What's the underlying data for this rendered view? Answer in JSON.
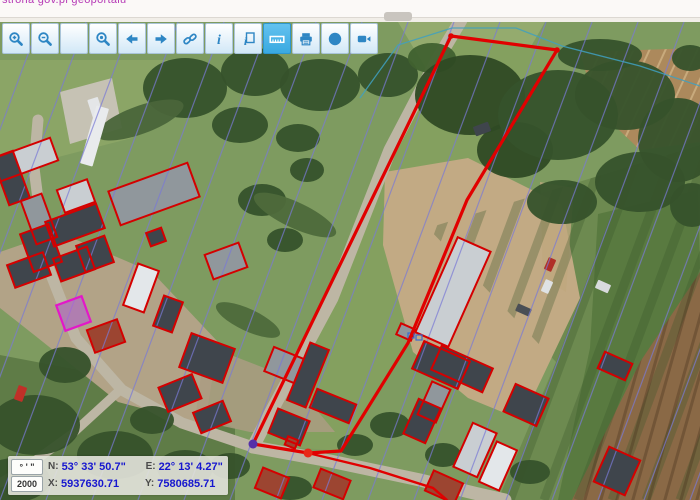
{
  "page": {
    "link_text": "strona gov.pl geoportalu"
  },
  "toolbar": {
    "buttons": [
      {
        "name": "zoom-in",
        "icon": "zoom-in-icon",
        "active": false
      },
      {
        "name": "zoom-out",
        "icon": "zoom-out-icon",
        "active": false
      },
      {
        "name": "pan",
        "icon": "pan-icon",
        "active": false
      },
      {
        "name": "zoom-extent",
        "icon": "zoom-extent-icon",
        "active": false
      },
      {
        "name": "back",
        "icon": "back-arrow-icon",
        "active": false
      },
      {
        "name": "forward",
        "icon": "forward-arrow-icon",
        "active": false
      },
      {
        "name": "link",
        "icon": "link-icon",
        "active": false
      },
      {
        "name": "info",
        "icon": "info-icon",
        "active": false
      },
      {
        "name": "identify",
        "icon": "identify-icon",
        "active": false
      },
      {
        "name": "measure",
        "icon": "measure-icon",
        "active": true
      },
      {
        "name": "print",
        "icon": "print-icon",
        "active": false
      },
      {
        "name": "globe",
        "icon": "globe-icon",
        "active": false
      },
      {
        "name": "camera",
        "icon": "camera-icon",
        "active": false
      }
    ],
    "icon_color": "#2e86c4",
    "active_icon_color": "#ffffff"
  },
  "coords_panel": {
    "dms_button": "° ' \"",
    "scale_value": "2000",
    "n_label": "N:",
    "n_value": "53° 33' 50.7\"",
    "e_label": "E:",
    "e_value": "22° 13' 4.27\"",
    "x_label": "X:",
    "x_value": "5937630.71",
    "y_label": "Y:",
    "y_value": "7580685.71"
  },
  "map": {
    "base_color": "#7e9b60",
    "roof_colors": {
      "dark": "#3f454c",
      "gray": "#90979c",
      "light": "#c9ced2",
      "white": "#e3e7ea",
      "red": "#9c4531",
      "tan": "#b9a98e"
    },
    "parcel_color": "#e10000",
    "cadastral_color": "#7a7ad6",
    "cyan_color": "#3fa0c0",
    "magenta_color": "#e318c8",
    "patches": [
      {
        "pts": [
          [
            0,
            60
          ],
          [
            168,
            60
          ],
          [
            132,
            138
          ],
          [
            0,
            172
          ]
        ],
        "fill": "#8ba566"
      },
      {
        "pts": [
          [
            398,
            22
          ],
          [
            545,
            22
          ],
          [
            522,
            62
          ],
          [
            428,
            72
          ]
        ],
        "fill": "#94ab6e"
      },
      {
        "pts": [
          [
            451,
            36
          ],
          [
            557,
            50
          ],
          [
            467,
            200
          ],
          [
            408,
            343
          ],
          [
            341,
            451
          ],
          [
            253,
            444
          ]
        ],
        "fill": "#84a05f"
      },
      {
        "pts": [
          [
            428,
            228
          ],
          [
            700,
            145
          ],
          [
            700,
            500
          ],
          [
            498,
            500
          ],
          [
            556,
            362
          ]
        ],
        "fill": "#6d8a50"
      },
      {
        "pts": [
          [
            598,
            214
          ],
          [
            698,
            190
          ],
          [
            700,
            268
          ],
          [
            622,
            500
          ],
          [
            558,
            500
          ],
          [
            590,
            348
          ]
        ],
        "fill": "#597a40"
      },
      {
        "pts": [
          [
            580,
            52
          ],
          [
            700,
            48
          ],
          [
            700,
            142
          ],
          [
            640,
            150
          ],
          [
            596,
            108
          ]
        ],
        "fill": "#ac895c"
      },
      {
        "pts": [
          [
            700,
            272
          ],
          [
            700,
            500
          ],
          [
            572,
            500
          ],
          [
            640,
            362
          ]
        ],
        "fill": "#8a6946"
      },
      {
        "pts": [
          [
            0,
            355
          ],
          [
            120,
            378
          ],
          [
            235,
            428
          ],
          [
            235,
            500
          ],
          [
            0,
            500
          ]
        ],
        "fill": "#5f7c47"
      },
      {
        "pts": [
          [
            0,
            252
          ],
          [
            58,
            232
          ],
          [
            152,
            272
          ],
          [
            218,
            342
          ],
          [
            205,
            425
          ],
          [
            118,
            402
          ],
          [
            38,
            338
          ],
          [
            0,
            308
          ]
        ],
        "fill": "#b2a387"
      },
      {
        "pts": [
          [
            205,
            345
          ],
          [
            290,
            378
          ],
          [
            335,
            432
          ],
          [
            250,
            432
          ],
          [
            195,
            420
          ]
        ],
        "fill": "#aa9c82",
        "opacity": 0.85
      },
      {
        "pts": [
          [
            385,
            172
          ],
          [
            468,
            158
          ],
          [
            562,
            205
          ],
          [
            580,
            298
          ],
          [
            522,
            420
          ],
          [
            468,
            398
          ],
          [
            413,
            352
          ],
          [
            383,
            245
          ]
        ],
        "fill": "#c2aa84"
      },
      {
        "pts": [
          [
            540,
            182
          ],
          [
            574,
            188
          ],
          [
            566,
            292
          ],
          [
            543,
            278
          ]
        ],
        "fill": "#bfa77e",
        "opacity": 0.8
      },
      {
        "pts": [
          [
            60,
            92
          ],
          [
            112,
            78
          ],
          [
            122,
            128
          ],
          [
            70,
            144
          ]
        ],
        "fill": "#c6c2b4"
      }
    ],
    "stripe_groups": [
      {
        "clip": [
          [
            428,
            228
          ],
          [
            700,
            145
          ],
          [
            700,
            500
          ],
          [
            498,
            500
          ],
          [
            556,
            362
          ]
        ],
        "x_from": 470,
        "x_to": 870,
        "step": 34,
        "dx": -130,
        "y1": 150,
        "y2": 500,
        "color": "rgba(55,85,42,0.30)",
        "width": 9
      },
      {
        "clip": [
          [
            580,
            52
          ],
          [
            700,
            48
          ],
          [
            700,
            142
          ],
          [
            640,
            150
          ],
          [
            596,
            108
          ]
        ],
        "x_from": 590,
        "x_to": 780,
        "step": 16,
        "dx": -55,
        "y1": 40,
        "y2": 160,
        "color": "rgba(235,210,165,0.45)",
        "width": 2
      },
      {
        "clip": [
          [
            700,
            272
          ],
          [
            700,
            500
          ],
          [
            572,
            500
          ],
          [
            640,
            362
          ]
        ],
        "x_from": 620,
        "x_to": 850,
        "step": 16,
        "dx": -70,
        "y1": 260,
        "y2": 510,
        "color": "rgba(60,40,22,0.30)",
        "width": 3
      }
    ],
    "roads": [
      {
        "pts": [
          [
            461,
            20
          ],
          [
            436,
            62
          ],
          [
            390,
            150
          ],
          [
            332,
            298
          ],
          [
            271,
            412
          ],
          [
            253,
            447
          ]
        ],
        "width": 13
      },
      {
        "pts": [
          [
            253,
            447
          ],
          [
            330,
            461
          ],
          [
            420,
            480
          ],
          [
            478,
            494
          ],
          [
            505,
            500
          ]
        ],
        "width": 13
      },
      {
        "pts": [
          [
            253,
            447
          ],
          [
            182,
            423
          ],
          [
            122,
            390
          ],
          [
            76,
            338
          ],
          [
            46,
            262
          ],
          [
            34,
            168
          ],
          [
            38,
            120
          ]
        ],
        "width": 11
      },
      {
        "pts": [
          [
            120,
            390
          ],
          [
            72,
            434
          ],
          [
            22,
            470
          ],
          [
            0,
            483
          ]
        ],
        "width": 9
      }
    ],
    "road_color": "#bdb6a4",
    "trees": [
      [
        185,
        88,
        42,
        30,
        0
      ],
      [
        255,
        72,
        34,
        24,
        0
      ],
      [
        320,
        85,
        40,
        26,
        0
      ],
      [
        388,
        75,
        30,
        22,
        0
      ],
      [
        432,
        58,
        24,
        15,
        0,
        "#40612f"
      ],
      [
        240,
        125,
        28,
        18,
        0
      ],
      [
        298,
        138,
        22,
        14,
        0
      ],
      [
        262,
        200,
        24,
        16,
        0
      ],
      [
        285,
        240,
        18,
        12,
        0
      ],
      [
        307,
        170,
        17,
        12,
        0
      ],
      [
        470,
        95,
        55,
        40,
        0,
        "#2f4a24"
      ],
      [
        515,
        150,
        38,
        28,
        0,
        "#2f4a24"
      ],
      [
        558,
        115,
        60,
        45,
        0
      ],
      [
        625,
        95,
        50,
        35,
        0
      ],
      [
        678,
        140,
        40,
        42,
        0
      ],
      [
        640,
        182,
        45,
        30,
        0
      ],
      [
        562,
        202,
        35,
        22,
        0
      ],
      [
        600,
        55,
        42,
        16,
        0
      ],
      [
        692,
        205,
        22,
        22,
        0
      ],
      [
        140,
        120,
        46,
        14,
        -20,
        "#4a653a"
      ],
      [
        295,
        215,
        45,
        13,
        25,
        "#4e6a3b"
      ],
      [
        248,
        320,
        35,
        11,
        25,
        "#4e6a3b"
      ],
      [
        35,
        425,
        45,
        30,
        0
      ],
      [
        115,
        455,
        38,
        24,
        0
      ],
      [
        185,
        468,
        28,
        18,
        0
      ],
      [
        65,
        365,
        26,
        18,
        0
      ],
      [
        15,
        480,
        35,
        22,
        0
      ],
      [
        152,
        420,
        22,
        14,
        0
      ],
      [
        230,
        466,
        20,
        13,
        0
      ],
      [
        290,
        488,
        22,
        12,
        0
      ],
      [
        355,
        445,
        18,
        11,
        0
      ],
      [
        390,
        425,
        20,
        13,
        0
      ],
      [
        443,
        455,
        18,
        12,
        0
      ],
      [
        530,
        472,
        20,
        12,
        0
      ],
      [
        690,
        58,
        18,
        13,
        0
      ]
    ],
    "tree_color": "#36522b",
    "vehicles": [
      [
        16,
        386,
        9,
        15,
        20,
        "#c03028"
      ],
      [
        90,
        98,
        11,
        20,
        -18,
        "#e4e6e8"
      ],
      [
        546,
        258,
        8,
        13,
        24,
        "#b03028"
      ],
      [
        543,
        280,
        8,
        13,
        24,
        "#dfe2e4"
      ],
      [
        516,
        306,
        15,
        8,
        24,
        "#4a4f55"
      ],
      [
        474,
        124,
        16,
        10,
        -20,
        "#3f454c"
      ],
      [
        596,
        282,
        14,
        9,
        24,
        "#d8dadd"
      ],
      [
        88,
        106,
        13,
        60,
        16,
        "#e9ebed"
      ]
    ],
    "buildings": [
      [
        -8,
        148,
        64,
        24,
        -20,
        "light",
        "red"
      ],
      [
        112,
        176,
        84,
        36,
        -20,
        "gray",
        "red"
      ],
      [
        0,
        153,
        22,
        50,
        -20,
        "dark",
        "red"
      ],
      [
        28,
        196,
        22,
        46,
        -20,
        "gray",
        "red"
      ],
      [
        48,
        212,
        54,
        26,
        -20,
        "dark",
        "red"
      ],
      [
        60,
        184,
        32,
        24,
        -20,
        "light",
        "red"
      ],
      [
        26,
        228,
        30,
        40,
        -20,
        "dark",
        "red"
      ],
      [
        80,
        240,
        30,
        28,
        -20,
        "dark",
        "red"
      ],
      [
        10,
        258,
        38,
        24,
        -20,
        "dark",
        "red"
      ],
      [
        56,
        252,
        36,
        24,
        -20,
        "dark",
        "red"
      ],
      [
        60,
        300,
        27,
        27,
        -20,
        "gray",
        "magenta"
      ],
      [
        90,
        324,
        32,
        24,
        -20,
        "red",
        "red"
      ],
      [
        130,
        266,
        22,
        44,
        20,
        "white",
        "red"
      ],
      [
        158,
        298,
        20,
        32,
        20,
        "dark",
        "red"
      ],
      [
        184,
        340,
        46,
        36,
        20,
        "dark",
        "red"
      ],
      [
        208,
        248,
        36,
        26,
        -20,
        "gray",
        "red"
      ],
      [
        148,
        230,
        16,
        14,
        -20,
        "dark",
        "red"
      ],
      [
        298,
        344,
        20,
        62,
        22,
        "dark",
        "red"
      ],
      [
        312,
        396,
        42,
        20,
        22,
        "dark",
        "red"
      ],
      [
        268,
        352,
        32,
        26,
        22,
        "gray",
        "red"
      ],
      [
        272,
        414,
        34,
        26,
        22,
        "dark",
        "red"
      ],
      [
        286,
        438,
        11,
        9,
        22,
        "red",
        "red"
      ],
      [
        258,
        472,
        28,
        22,
        22,
        "red",
        "red"
      ],
      [
        316,
        474,
        32,
        20,
        22,
        "red",
        "red"
      ],
      [
        162,
        380,
        36,
        26,
        -22,
        "dark",
        "red"
      ],
      [
        196,
        406,
        32,
        22,
        -22,
        "dark",
        "red"
      ],
      [
        435,
        240,
        36,
        104,
        24,
        "light",
        "red"
      ],
      [
        416,
        350,
        50,
        30,
        24,
        "dark",
        "red"
      ],
      [
        398,
        326,
        16,
        12,
        24,
        "gray",
        "red"
      ],
      [
        434,
        356,
        56,
        26,
        24,
        "dark",
        "red"
      ],
      [
        424,
        384,
        20,
        36,
        24,
        "gray",
        "red"
      ],
      [
        410,
        402,
        24,
        38,
        24,
        "dark",
        "red"
      ],
      [
        508,
        390,
        36,
        30,
        24,
        "dark",
        "red"
      ],
      [
        462,
        426,
        26,
        48,
        24,
        "light",
        "red"
      ],
      [
        487,
        444,
        22,
        44,
        24,
        "white",
        "red"
      ],
      [
        428,
        476,
        32,
        22,
        24,
        "red",
        "red"
      ],
      [
        600,
        357,
        30,
        18,
        24,
        "dark",
        "red"
      ],
      [
        600,
        452,
        34,
        38,
        24,
        "dark",
        "red"
      ]
    ],
    "blue_lines": {
      "x_from": 40,
      "x_to": 900,
      "step": 46,
      "dx": -178,
      "y1": 22,
      "y2": 500,
      "width": 1.2,
      "opacity": 0.7
    },
    "cyan_line": [
      [
        360,
        98
      ],
      [
        398,
        45
      ],
      [
        452,
        28
      ],
      [
        516,
        28
      ],
      [
        562,
        46
      ],
      [
        640,
        66
      ],
      [
        700,
        86
      ]
    ],
    "parcel": [
      [
        451,
        36
      ],
      [
        557,
        50
      ],
      [
        467,
        200
      ],
      [
        408,
        343
      ],
      [
        341,
        451
      ],
      [
        308,
        453
      ],
      [
        253,
        444
      ]
    ],
    "red_lines": [
      [
        [
          308,
          453
        ],
        [
          370,
          468
        ],
        [
          433,
          488
        ],
        [
          447,
          500
        ]
      ]
    ],
    "blue_symbols": [
      [
        408,
        333,
        6,
        5
      ],
      [
        416,
        335,
        6,
        5
      ]
    ],
    "markers": {
      "vertex_purple": {
        "x": 253,
        "y": 444,
        "r": 4.5,
        "color": "#5530a8"
      },
      "vertex_red": {
        "x": 308,
        "y": 453,
        "r": 4.5,
        "color": "#e82818"
      },
      "corner_dots": [
        [
          451,
          36
        ],
        [
          557,
          50
        ]
      ],
      "corner_color": "#e10000"
    }
  }
}
